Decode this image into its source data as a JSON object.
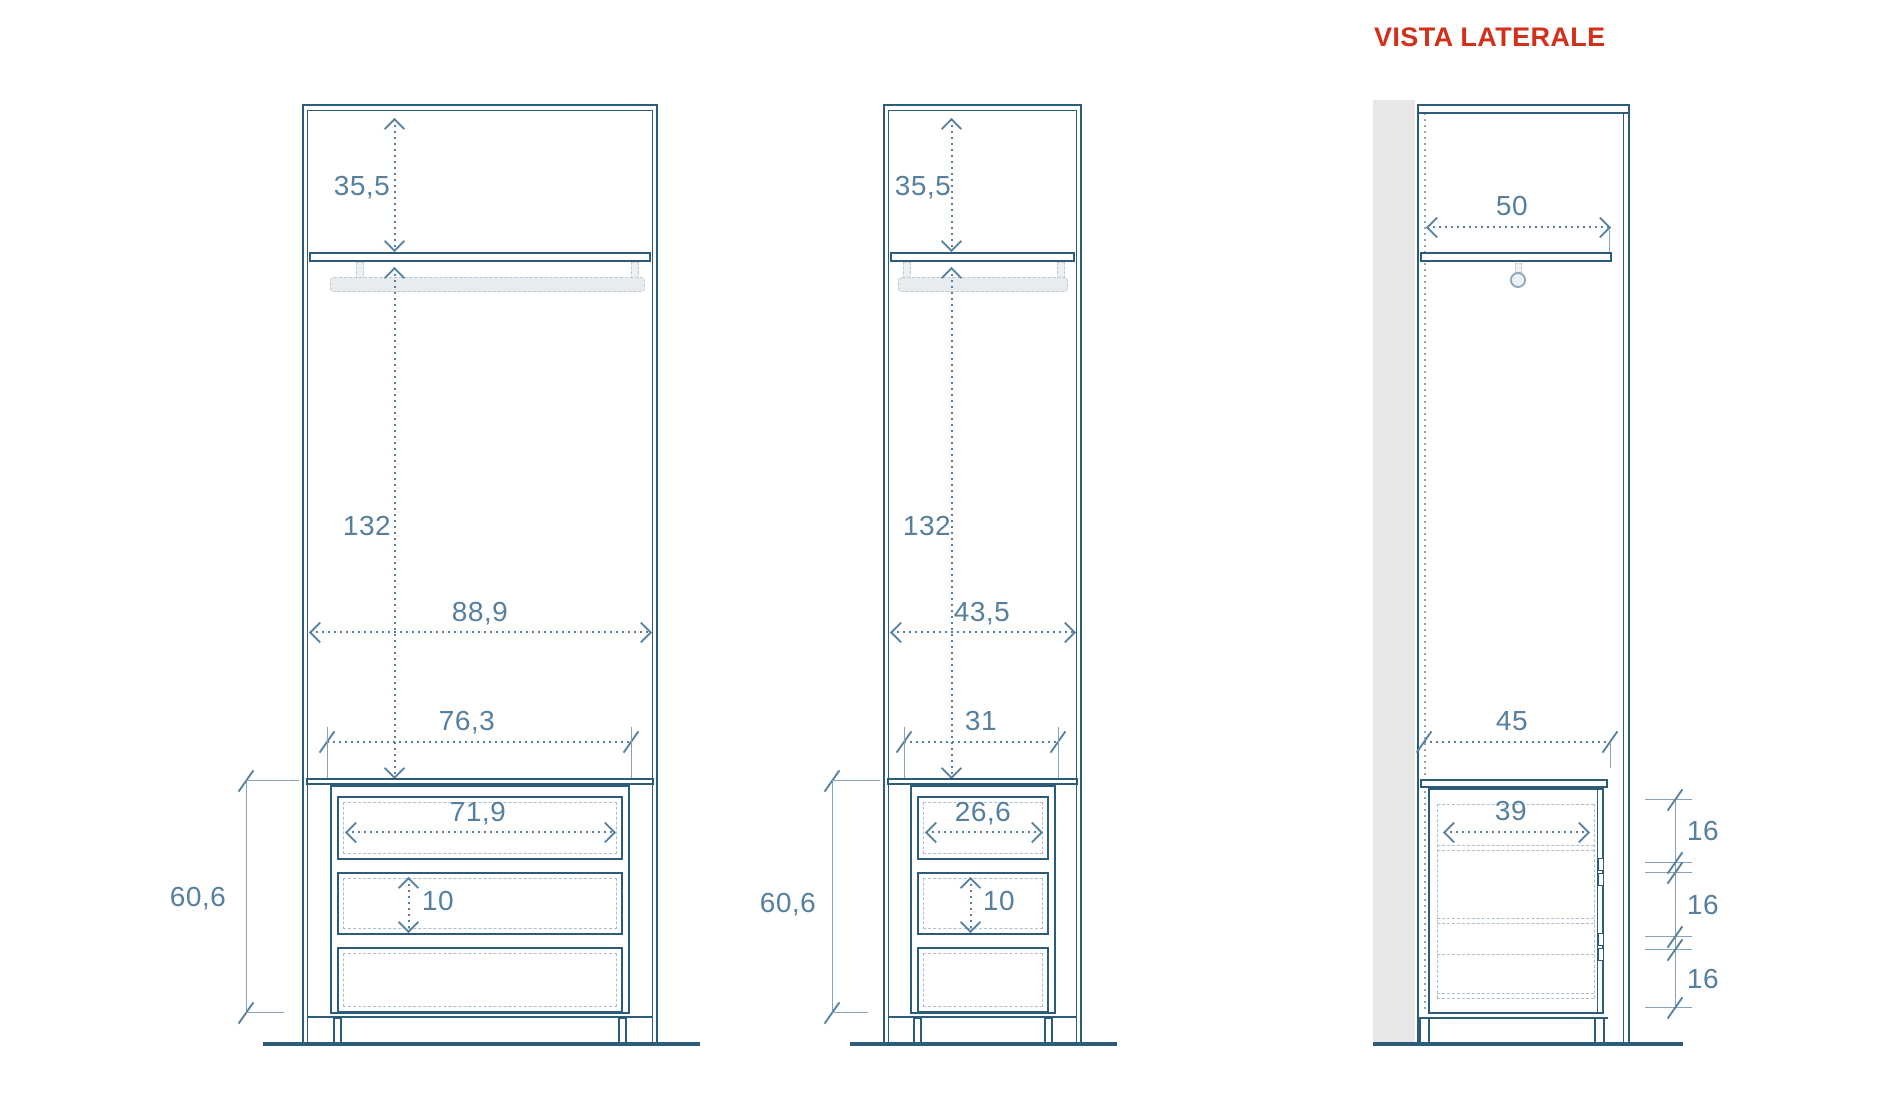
{
  "title": "VISTA LATERALE",
  "colors": {
    "line": "#2c5c78",
    "dimension": "#56809e",
    "dashed_detail": "#a9bfd0",
    "title": "#d23019",
    "wall_fill": "#e8e8e8",
    "rail_fill": "#e9ecef"
  },
  "views": {
    "front_wide": {
      "dims": {
        "top_gap": "35,5",
        "hanging_height": "132",
        "inner_width": "88,9",
        "chest_width": "76,3",
        "drawer_width": "71,9",
        "drawer_height": "10",
        "chest_height": "60,6"
      }
    },
    "front_narrow": {
      "dims": {
        "top_gap": "35,5",
        "hanging_height": "132",
        "inner_width": "43,5",
        "chest_width": "31",
        "drawer_width": "26,6",
        "drawer_height": "10",
        "chest_height": "60,6"
      }
    },
    "side": {
      "dims": {
        "inner_depth": "50",
        "chest_depth": "45",
        "drawer_depth": "39",
        "drawer_spacings": [
          "16",
          "16",
          "16"
        ]
      }
    }
  }
}
